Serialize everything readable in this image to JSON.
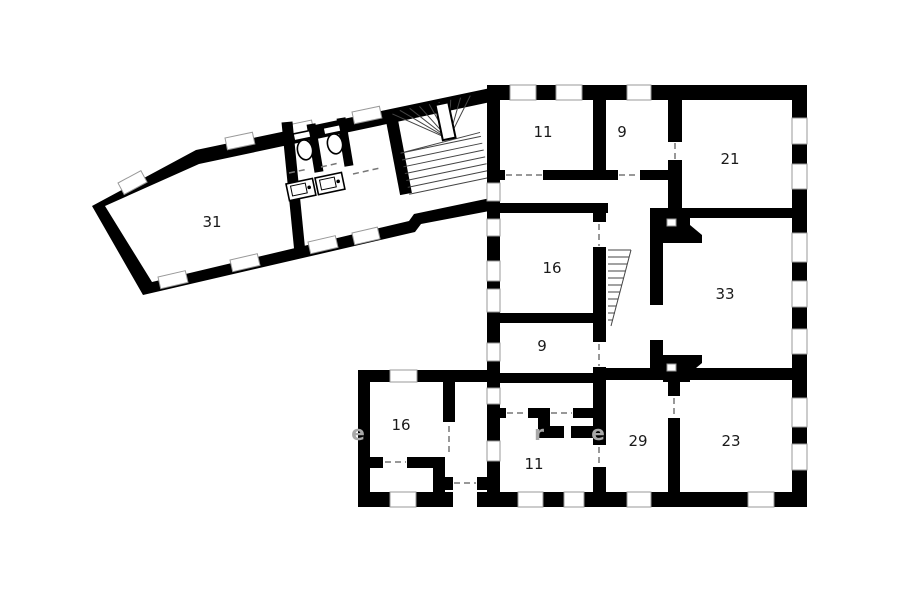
{
  "page": {
    "type": "architectural floor plan",
    "background": "#ffffff",
    "wall_color": "#000000",
    "window_outline_color": "#999999",
    "label_color": "#1a1a1a",
    "watermark_color": "#a8a8a8"
  },
  "rooms": [
    {
      "id": "room-31",
      "label": "31"
    },
    {
      "id": "room-11-top",
      "label": "11"
    },
    {
      "id": "room-9-top",
      "label": "9"
    },
    {
      "id": "room-21",
      "label": "21"
    },
    {
      "id": "room-16-mid",
      "label": "16"
    },
    {
      "id": "room-9-mid",
      "label": "9"
    },
    {
      "id": "room-33",
      "label": "33"
    },
    {
      "id": "room-16-low",
      "label": "16"
    },
    {
      "id": "room-11-low",
      "label": "11"
    },
    {
      "id": "room-29",
      "label": "29"
    },
    {
      "id": "room-23",
      "label": "23"
    }
  ],
  "watermark": {
    "fragments": [
      {
        "text": "e"
      },
      {
        "text": "r"
      },
      {
        "text": "e"
      }
    ]
  },
  "features": {
    "stairs": [
      "winder-staircase-west-wing",
      "narrow-side-stair-corridor"
    ],
    "fixtures": [
      "toilet",
      "toilet",
      "sink",
      "sink"
    ],
    "chimneys": 2
  }
}
